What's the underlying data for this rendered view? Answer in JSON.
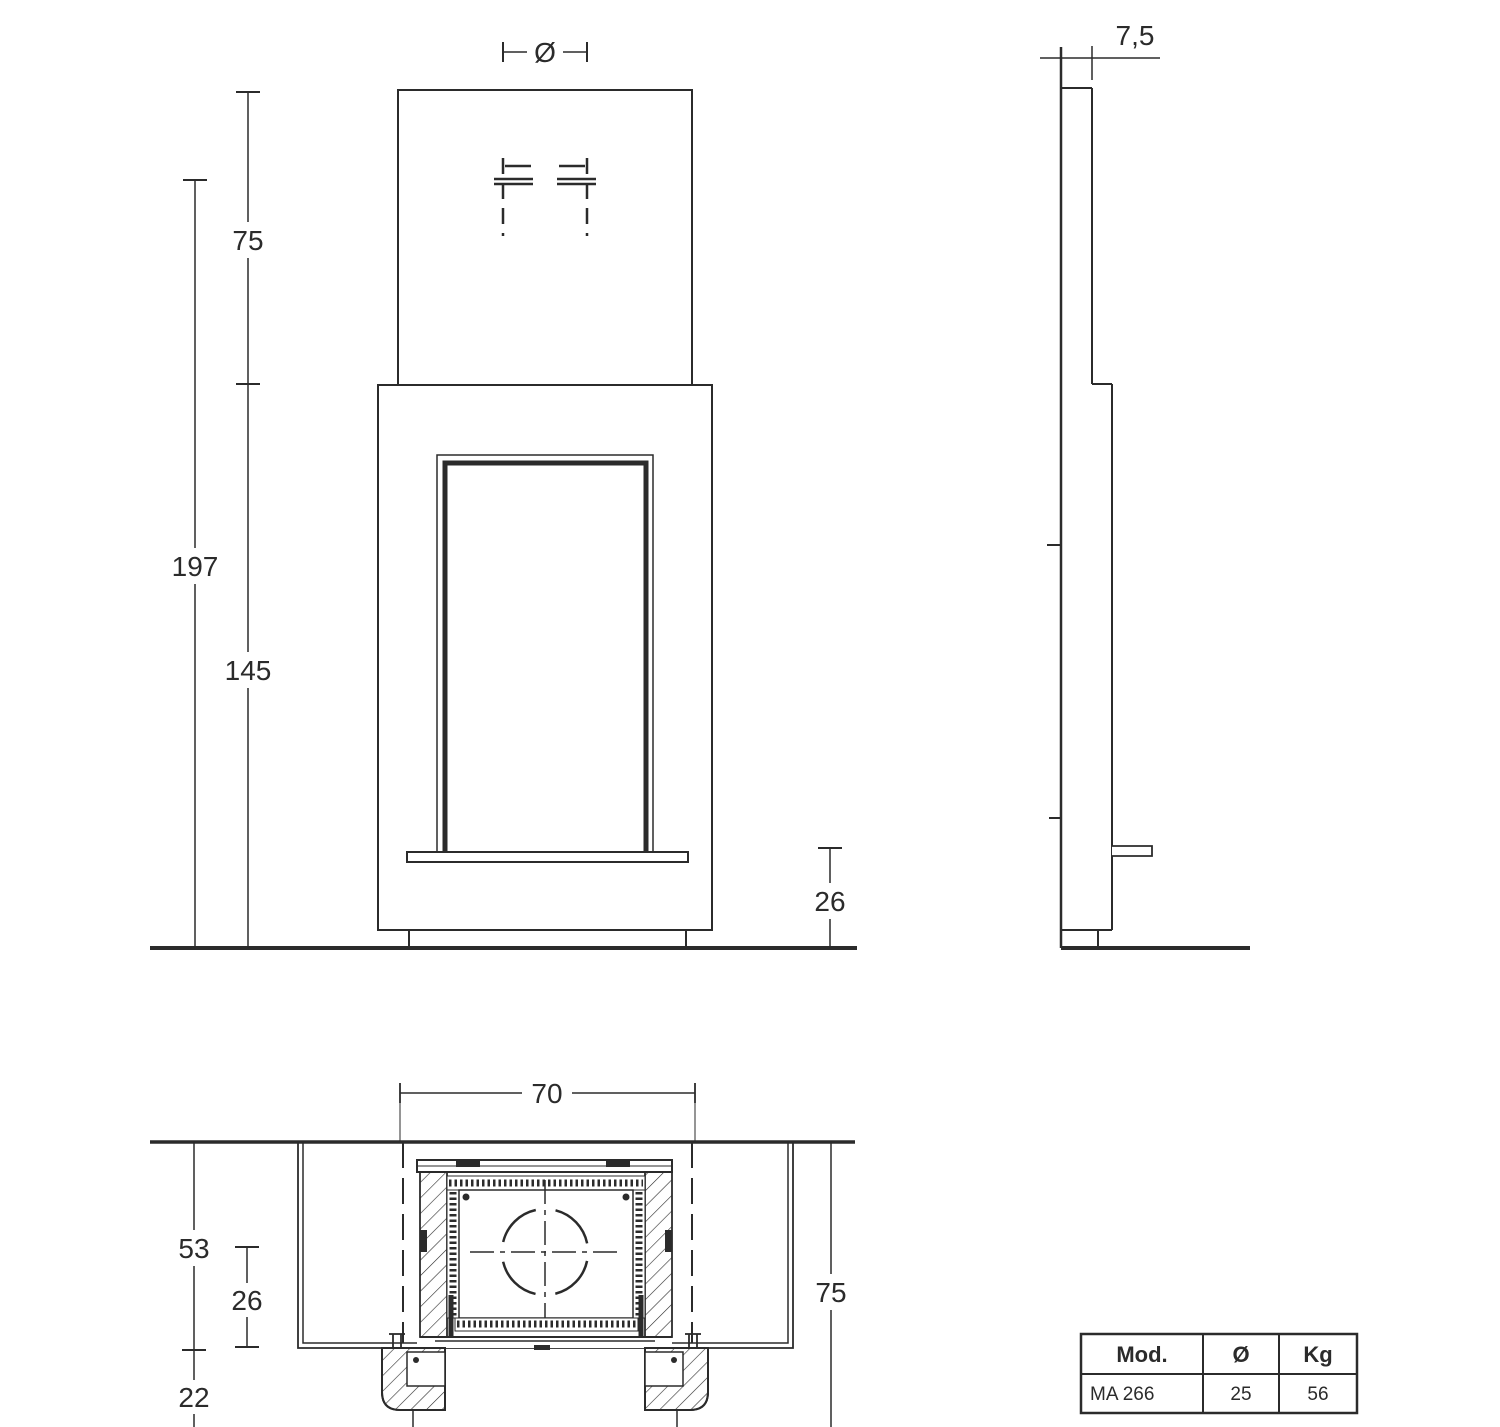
{
  "drawing": {
    "front_view": {
      "flue_diameter_label": "Ø",
      "upper_height": "75",
      "total_height": "197",
      "body_height": "145",
      "base_height": "26"
    },
    "side_view": {
      "top_depth": "7,5"
    },
    "plan_view": {
      "opening_width": "70",
      "recess_depth": "53",
      "hearth_depth": "26",
      "front_offset": "22",
      "total_depth": "75"
    }
  },
  "spec_table": {
    "headers": [
      "Mod.",
      "Ø",
      "Kg"
    ],
    "rows": [
      [
        "MA 266",
        "25",
        "56"
      ]
    ]
  },
  "colors": {
    "line": "#2b2b2b",
    "background": "#ffffff"
  }
}
